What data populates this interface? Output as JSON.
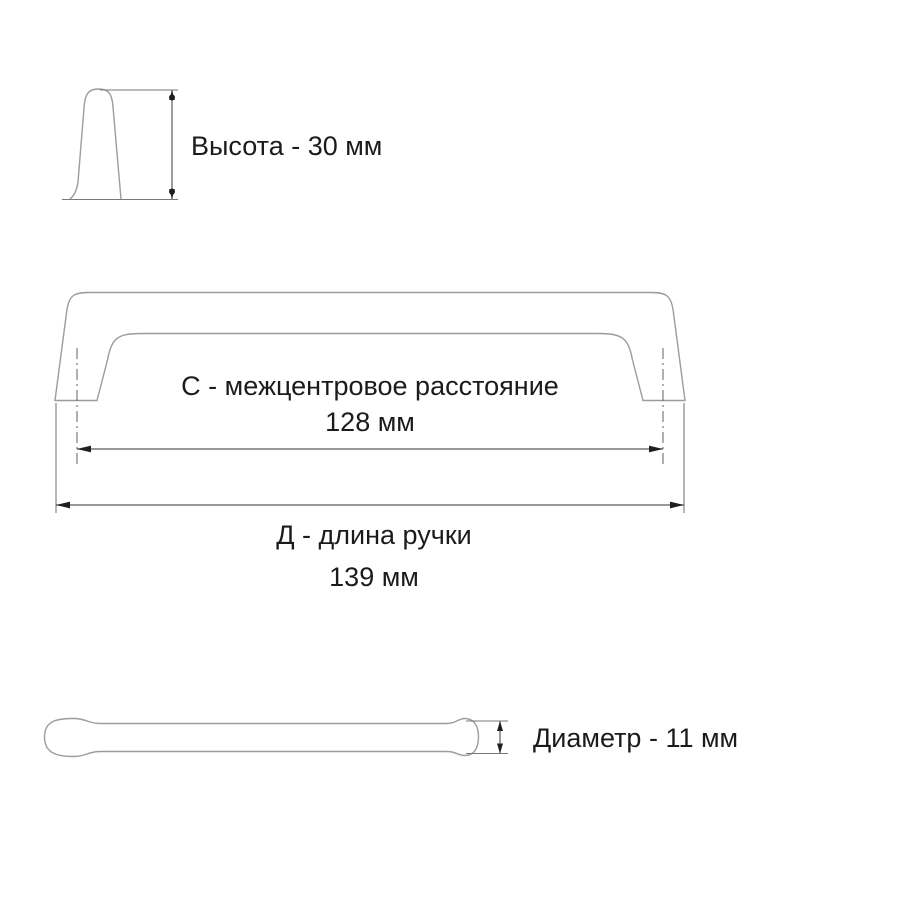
{
  "colors": {
    "background": "#ffffff",
    "outline": "#9c9c9c",
    "dimension_lines": "#5a5a5a",
    "text": "#1b1b1b"
  },
  "drawing": {
    "subject": "furniture handle dimension drawing",
    "dimensions": {
      "height": {
        "label": "Высота - 30 мм"
      },
      "center_distance": {
        "label": "С - межцентровое расстояние",
        "value": "128 мм"
      },
      "length": {
        "label": "Д - длина ручки",
        "value": "139 мм"
      },
      "diameter": {
        "label": "Диаметр - 11 мм"
      }
    }
  }
}
